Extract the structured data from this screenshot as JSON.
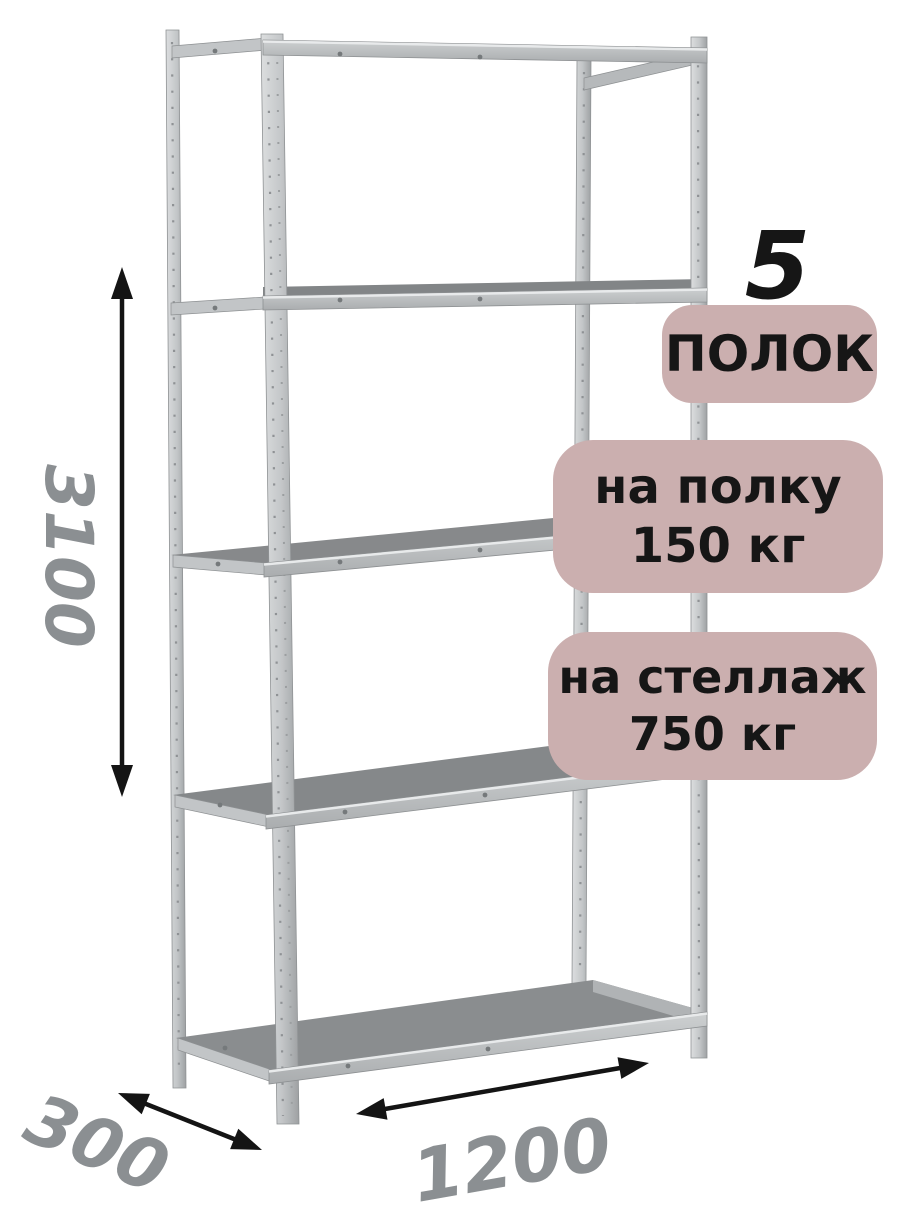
{
  "badges": {
    "shelf_count": {
      "number": "5",
      "label": "ПОЛОК"
    },
    "per_shelf": {
      "line1": "на полку",
      "line2": "150 кг"
    },
    "per_rack": {
      "line1": "на стеллаж",
      "line2": "750 кг"
    }
  },
  "dimensions": {
    "height": "3100",
    "depth": "300",
    "width": "1200"
  },
  "colors": {
    "badge_bg": "#cbafaf",
    "dimension_text": "#8b8f92",
    "arrow": "#141414",
    "text": "#161616",
    "background": "#ffffff",
    "shelf_top": "#87898b",
    "metal_light": "#d8dadb",
    "metal_dark": "#aaadaf"
  }
}
